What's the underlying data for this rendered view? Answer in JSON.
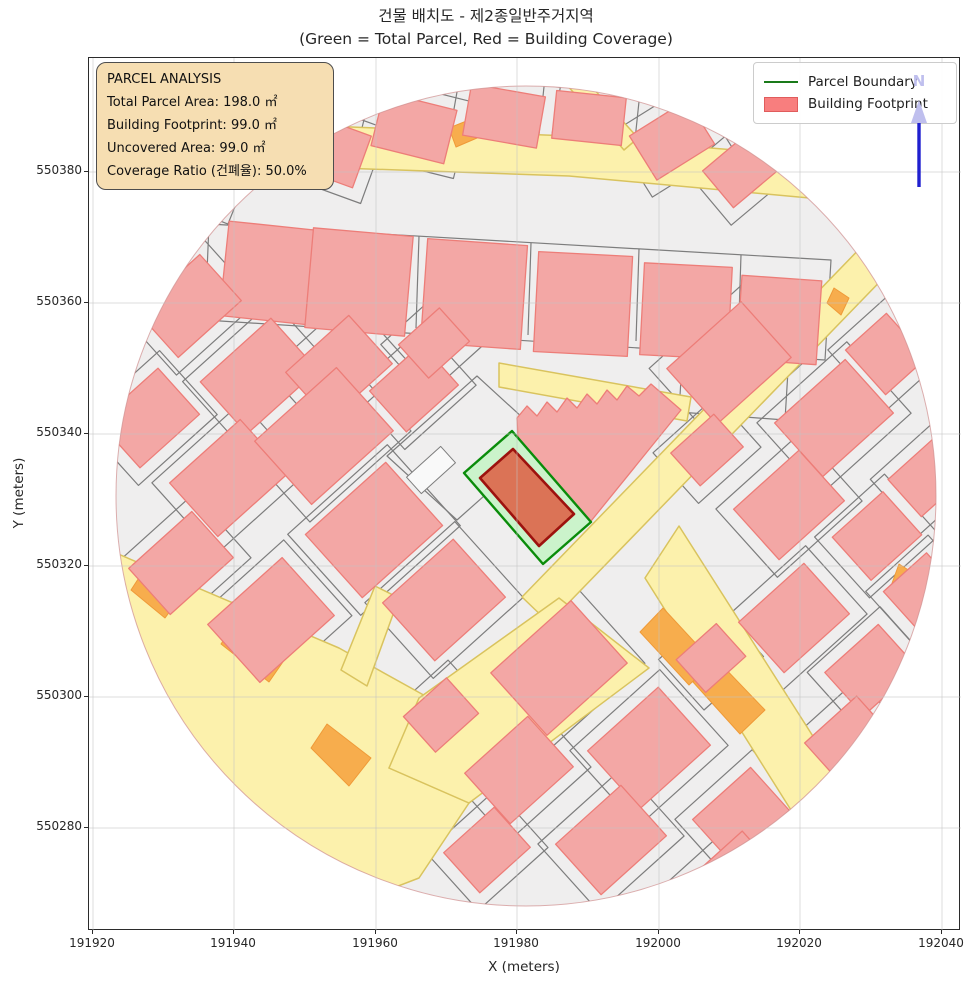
{
  "figure": {
    "title_line1": "건물 배치도 - 제2종일반주거지역",
    "title_line2": "(Green = Total Parcel, Red = Building Coverage)"
  },
  "axes": {
    "x_label": "X (meters)",
    "y_label": "Y (meters)",
    "x_ticks": [
      {
        "label": "191920",
        "px": 92
      },
      {
        "label": "191940",
        "px": 233
      },
      {
        "label": "191960",
        "px": 375
      },
      {
        "label": "191980",
        "px": 516
      },
      {
        "label": "192000",
        "px": 658
      },
      {
        "label": "192020",
        "px": 799
      },
      {
        "label": "192040",
        "px": 941
      }
    ],
    "y_ticks": [
      {
        "label": "550380",
        "px": 171
      },
      {
        "label": "550360",
        "px": 302
      },
      {
        "label": "550340",
        "px": 433
      },
      {
        "label": "550320",
        "px": 565
      },
      {
        "label": "550300",
        "px": 696
      },
      {
        "label": "550280",
        "px": 827
      }
    ]
  },
  "info_box": {
    "lines": [
      "PARCEL ANALYSIS",
      "Total Parcel Area: 198.0 ㎡",
      "Building Footprint: 99.0 ㎡",
      "Uncovered Area: 99.0 ㎡",
      "Coverage Ratio (건폐율): 50.0%"
    ]
  },
  "legend": {
    "items": [
      {
        "label": "Parcel Boundary",
        "swatch": "line",
        "color": "#1a7a1a"
      },
      {
        "label": "Building Footprint",
        "swatch": "patch",
        "color": "#f87e7e"
      }
    ]
  },
  "north_arrow": {
    "label": "N",
    "shaft_color": "#2020cf",
    "head_color": "#bfbfee"
  },
  "palette": {
    "base": "#efeeee",
    "parcel_line": "#7d7d7d",
    "road_fill": "#fcf1ac",
    "road_edge": "#d9c35e",
    "orange_fill": "#f7ad4d",
    "orange_edge": "#ef9a38",
    "building_fill": "#f3a7a5",
    "building_edge": "#ed7d78",
    "parcel_green_fill": "#cbf3cb",
    "parcel_green_edge": "#0a8c0a",
    "center_building_fill": "#db7356",
    "center_building_edge": "#9d120e",
    "circle_edge": "#cf8d8d",
    "grid": "#c3c3c3",
    "notch_fill": "#f9f9f9"
  },
  "map": {
    "circle": {
      "cx": 437,
      "cy": 438,
      "r": 410
    },
    "grid_x": [
      4,
      145,
      287,
      428,
      570,
      711,
      853
    ],
    "grid_y": [
      114,
      245,
      376,
      508,
      639,
      770
    ],
    "roads": [
      [
        [
          140,
          64
        ],
        [
          480,
          78
        ],
        [
          740,
          100
        ],
        [
          742,
          142
        ],
        [
          480,
          118
        ],
        [
          138,
          106
        ]
      ],
      [
        [
          470,
          18
        ],
        [
          484,
          8
        ],
        [
          549,
          80
        ],
        [
          535,
          92
        ]
      ],
      [
        [
          812,
          148
        ],
        [
          839,
          174
        ],
        [
          460,
          565
        ],
        [
          433,
          539
        ]
      ],
      [
        [
          590,
          468
        ],
        [
          748,
          716
        ],
        [
          712,
          768
        ],
        [
          556,
          520
        ]
      ],
      [
        [
          410,
          305
        ],
        [
          602,
          339
        ],
        [
          598,
          363
        ],
        [
          410,
          329
        ]
      ],
      [
        [
          15,
          490
        ],
        [
          250,
          590
        ],
        [
          340,
          640
        ],
        [
          300,
          710
        ],
        [
          380,
          745
        ],
        [
          330,
          820
        ],
        [
          200,
          870
        ],
        [
          40,
          700
        ]
      ],
      [
        [
          330,
          640
        ],
        [
          470,
          540
        ],
        [
          560,
          610
        ],
        [
          380,
          745
        ],
        [
          300,
          710
        ]
      ],
      [
        [
          252,
          612
        ],
        [
          286,
          528
        ],
        [
          310,
          540
        ],
        [
          278,
          628
        ]
      ]
    ],
    "orange": [
      [
        [
          55,
          512
        ],
        [
          92,
          538
        ],
        [
          76,
          560
        ],
        [
          42,
          532
        ]
      ],
      [
        [
          148,
          562
        ],
        [
          198,
          598
        ],
        [
          180,
          624
        ],
        [
          132,
          586
        ]
      ],
      [
        [
          238,
          666
        ],
        [
          282,
          700
        ],
        [
          260,
          728
        ],
        [
          222,
          690
        ]
      ],
      [
        [
          574,
          550
        ],
        [
          624,
          604
        ],
        [
          600,
          627
        ],
        [
          551,
          574
        ]
      ],
      [
        [
          627,
          601
        ],
        [
          676,
          652
        ],
        [
          651,
          676
        ],
        [
          604,
          624
        ]
      ],
      [
        [
          810,
          506
        ],
        [
          832,
          520
        ],
        [
          822,
          546
        ],
        [
          802,
          528
        ]
      ],
      [
        [
          360,
          70
        ],
        [
          380,
          62
        ],
        [
          388,
          80
        ],
        [
          367,
          89
        ]
      ],
      [
        [
          745,
          230
        ],
        [
          760,
          240
        ],
        [
          752,
          257
        ],
        [
          738,
          245
        ]
      ]
    ],
    "parcel_outlines": [
      [
        [
          120,
          166
        ],
        [
          742,
          202
        ],
        [
          736,
          302
        ],
        [
          116,
          262
        ]
      ],
      [
        [
          298,
          398
        ],
        [
          388,
          318
        ],
        [
          458,
          382
        ],
        [
          368,
          462
        ]
      ],
      [
        [
          594,
          288
        ],
        [
          700,
          296
        ],
        [
          696,
          362
        ],
        [
          590,
          354
        ]
      ]
    ],
    "parcel_lines": [
      [
        [
          222,
          172
        ],
        [
          219,
          264
        ]
      ],
      [
        [
          330,
          178
        ],
        [
          327,
          270
        ]
      ],
      [
        [
          442,
          185
        ],
        [
          439,
          277
        ]
      ],
      [
        [
          550,
          191
        ],
        [
          547,
          283
        ]
      ],
      [
        [
          652,
          197
        ],
        [
          649,
          289
        ]
      ]
    ],
    "buildings": [
      [
        240,
        92,
        70,
        55,
        20
      ],
      [
        325,
        70,
        75,
        55,
        14
      ],
      [
        415,
        58,
        75,
        52,
        10
      ],
      [
        500,
        60,
        70,
        48,
        6
      ],
      [
        583,
        82,
        68,
        52,
        -32
      ],
      [
        652,
        112,
        60,
        48,
        -40
      ],
      [
        180,
        215,
        90,
        95,
        6,
        0
      ],
      [
        270,
        224,
        100,
        100,
        5,
        0
      ],
      [
        385,
        236,
        100,
        104,
        4,
        0
      ],
      [
        494,
        246,
        94,
        100,
        3,
        0
      ],
      [
        597,
        253,
        88,
        92,
        3,
        0
      ],
      [
        690,
        262,
        80,
        84,
        4,
        0
      ],
      [
        100,
        248,
        85,
        62,
        -42
      ],
      [
        170,
        318,
        95,
        70,
        -42
      ],
      [
        250,
        310,
        85,
        65,
        -42
      ],
      [
        60,
        360,
        80,
        62,
        -42
      ],
      [
        140,
        420,
        95,
        72,
        -42
      ],
      [
        235,
        378,
        110,
        85,
        -42
      ],
      [
        325,
        330,
        70,
        55,
        -42
      ],
      [
        92,
        505,
        85,
        62,
        -42
      ],
      [
        182,
        562,
        100,
        78,
        -42
      ],
      [
        285,
        472,
        108,
        85,
        -42
      ],
      [
        355,
        542,
        95,
        78,
        -42
      ],
      [
        345,
        285,
        55,
        45,
        -42
      ],
      [
        640,
        305,
        100,
        75,
        -42
      ],
      [
        745,
        360,
        95,
        72,
        -42
      ],
      [
        700,
        447,
        88,
        68,
        -42
      ],
      [
        788,
        478,
        68,
        58,
        -42
      ],
      [
        618,
        392,
        58,
        44,
        -42
      ],
      [
        797,
        296,
        55,
        60,
        -42
      ],
      [
        838,
        420,
        60,
        50,
        -42
      ],
      [
        470,
        610,
        108,
        84,
        -42
      ],
      [
        560,
        690,
        95,
        78,
        -42
      ],
      [
        430,
        712,
        85,
        68,
        -42
      ],
      [
        522,
        782,
        88,
        68,
        -42
      ],
      [
        352,
        657,
        58,
        48,
        -42
      ],
      [
        622,
        600,
        54,
        44,
        -42
      ],
      [
        398,
        792,
        68,
        54,
        -42
      ],
      [
        705,
        560,
        88,
        68,
        -42
      ],
      [
        782,
        612,
        72,
        58,
        -42
      ],
      [
        760,
        682,
        70,
        55,
        -42
      ],
      [
        652,
        757,
        78,
        58,
        -42
      ],
      [
        640,
        822,
        85,
        55,
        -42
      ],
      [
        832,
        532,
        58,
        48,
        -42
      ],
      [
        60,
        150,
        70,
        50,
        25
      ],
      [
        112,
        118,
        60,
        45,
        22
      ]
    ],
    "sawtooth_building": [
      [
        428,
        360
      ],
      [
        438,
        348
      ],
      [
        448,
        358
      ],
      [
        458,
        344
      ],
      [
        468,
        354
      ],
      [
        478,
        340
      ],
      [
        488,
        350
      ],
      [
        498,
        336
      ],
      [
        508,
        346
      ],
      [
        518,
        332
      ],
      [
        528,
        342
      ],
      [
        538,
        328
      ],
      [
        550,
        338
      ],
      [
        562,
        326
      ],
      [
        592,
        352
      ],
      [
        498,
        468
      ],
      [
        430,
        402
      ]
    ],
    "white_notch": [
      342,
      412,
      46,
      22,
      -42
    ],
    "central_parcel": [
      [
        423,
        373
      ],
      [
        502,
        464
      ],
      [
        454,
        506
      ],
      [
        375,
        415
      ]
    ],
    "central_building": [
      [
        424,
        391
      ],
      [
        485,
        456
      ],
      [
        450,
        488
      ],
      [
        391,
        420
      ]
    ]
  },
  "chart_data": {
    "type": "map",
    "title": "건물 배치도 - 제2종일반주거지역",
    "subtitle": "(Green = Total Parcel, Red = Building Coverage)",
    "xlabel": "X (meters)",
    "ylabel": "Y (meters)",
    "xlim": [
      191919.4,
      192042.8
    ],
    "ylim": [
      550264.3,
      550397.4
    ],
    "x_ticks": [
      191920,
      191940,
      191960,
      191980,
      192000,
      192020,
      192040
    ],
    "y_ticks": [
      550280,
      550300,
      550320,
      550340,
      550360,
      550380
    ],
    "grid": true,
    "legend_position": "upper right",
    "legend": [
      "Parcel Boundary",
      "Building Footprint"
    ],
    "zoning": "제2종일반주거지역",
    "analysis": {
      "total_parcel_area_m2": 198.0,
      "building_footprint_m2": 99.0,
      "uncovered_area_m2": 99.0,
      "coverage_ratio_pct": 50.0
    },
    "map_extent_circle": {
      "center_x_m": 191981,
      "center_y_m": 550330,
      "radius_m": 60
    },
    "central_parcel": {
      "boundary_color": "green",
      "building_color": "red"
    }
  }
}
